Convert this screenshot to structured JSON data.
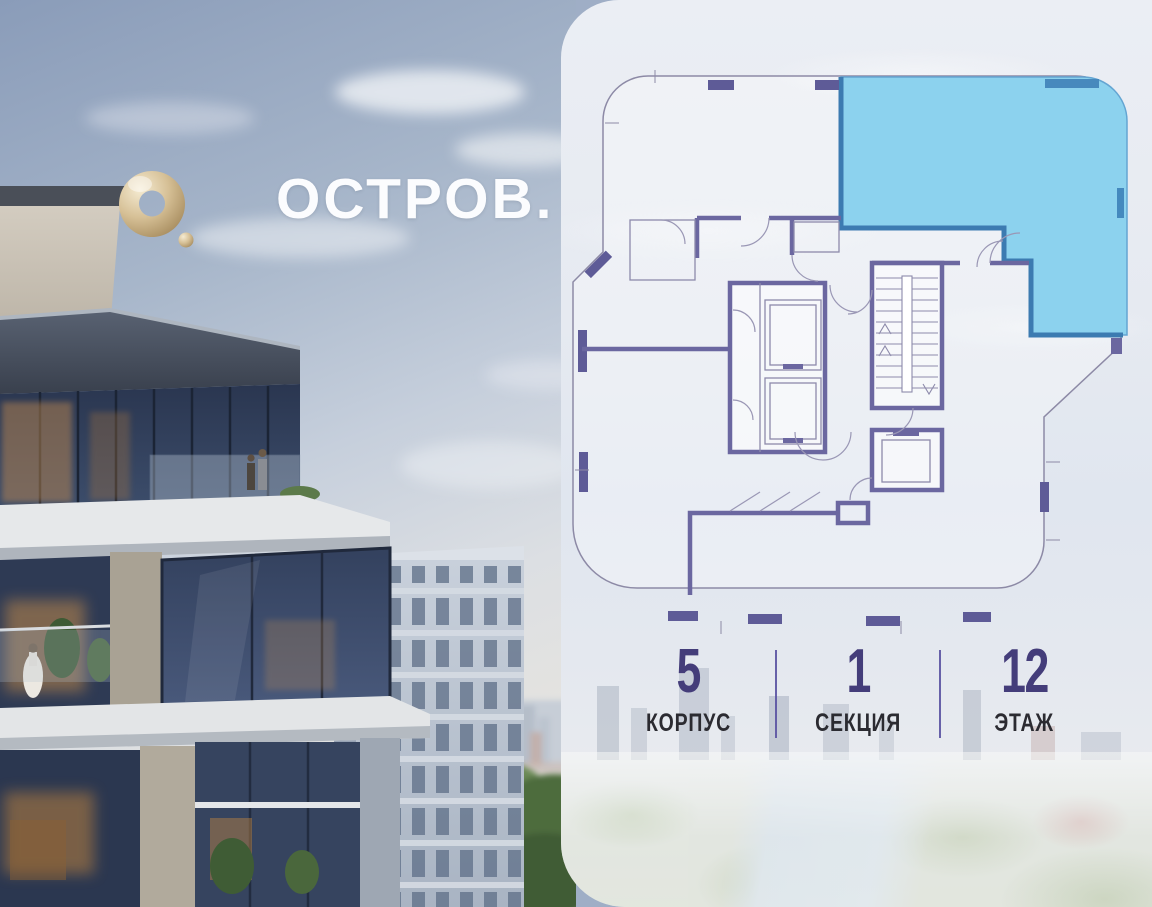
{
  "brand": {
    "name": "ОСТРОВ.",
    "logo_icon": "gold-ring-o-icon",
    "logo_color": "#C9B288",
    "text_color": "#FBFCFE"
  },
  "floor_plan": {
    "highlight_fill": "#8CD2EE",
    "highlight_wall": "#3C7BB1",
    "wall_color": "#6B67A0",
    "outline_color": "#8D8AA6",
    "window_marker_color": "#5E5B97"
  },
  "info": {
    "items": [
      {
        "value": "5",
        "label": "КОРПУС"
      },
      {
        "value": "1",
        "label": "СЕКЦИЯ"
      },
      {
        "value": "12",
        "label": "ЭТАЖ"
      }
    ],
    "value_color": "#443D7A",
    "label_color": "#2B2B31",
    "divider_color": "#5C55A3"
  }
}
